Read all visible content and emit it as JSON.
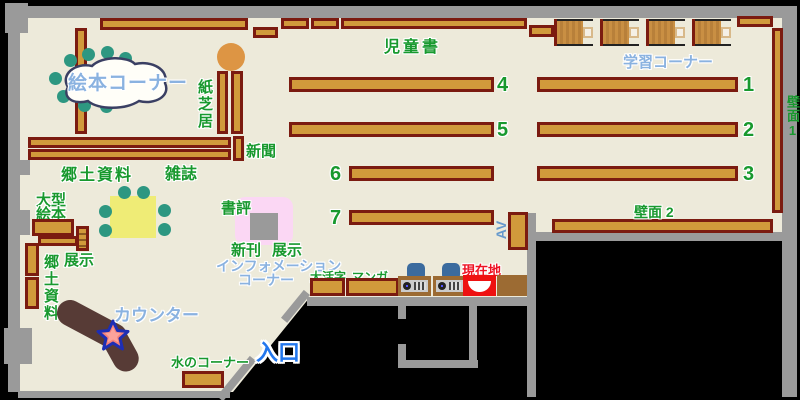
{
  "labels": {
    "ehon_corner": "絵本コーナー",
    "kamishibai": "紙芝居",
    "shinbun": "新聞",
    "kyodo_shiryo": "郷土資料",
    "kyodo_shiryo_vertical": "郷土資料",
    "zasshi": "雑誌",
    "ogata_line1": "大型",
    "ogata_line2": "絵本",
    "tenji_left": "展示",
    "jidosho": "児童書",
    "gakushu_corner": "学習コーナー",
    "hekimen1": "壁面1",
    "hekimen2": "壁面 2",
    "shohyo": "書評",
    "shinkan": "新刊",
    "tenji_right": "展示",
    "info_line1": "インフォメーション",
    "info_line2": "コーナー",
    "daikatsuji": "大活字",
    "manga": "マンガ",
    "genzaichi": "現在地",
    "counter": "カウンター",
    "mizu_corner": "水のコーナー",
    "iriguchi": "入口",
    "av": "AV"
  },
  "shelf_numbers": {
    "n1": "1",
    "n2": "2",
    "n3": "3",
    "n4": "4",
    "n5": "5",
    "n6": "6",
    "n7": "7"
  },
  "colors": {
    "floor": "#edeada",
    "wall": "#9a9a9a",
    "shelf": "#d19a3b",
    "shelf_border": "#7b1b10",
    "counter": "#573b36",
    "table": "#efec76",
    "chair_teal": "#2d9781",
    "display_pink": "#fbd7f4",
    "current_location_red": "#ee1111",
    "label_green": "#18992e",
    "label_blue": "#8ab2e0",
    "entrance_blue": "#2277ee",
    "round_table_orange": "#dd9544"
  }
}
